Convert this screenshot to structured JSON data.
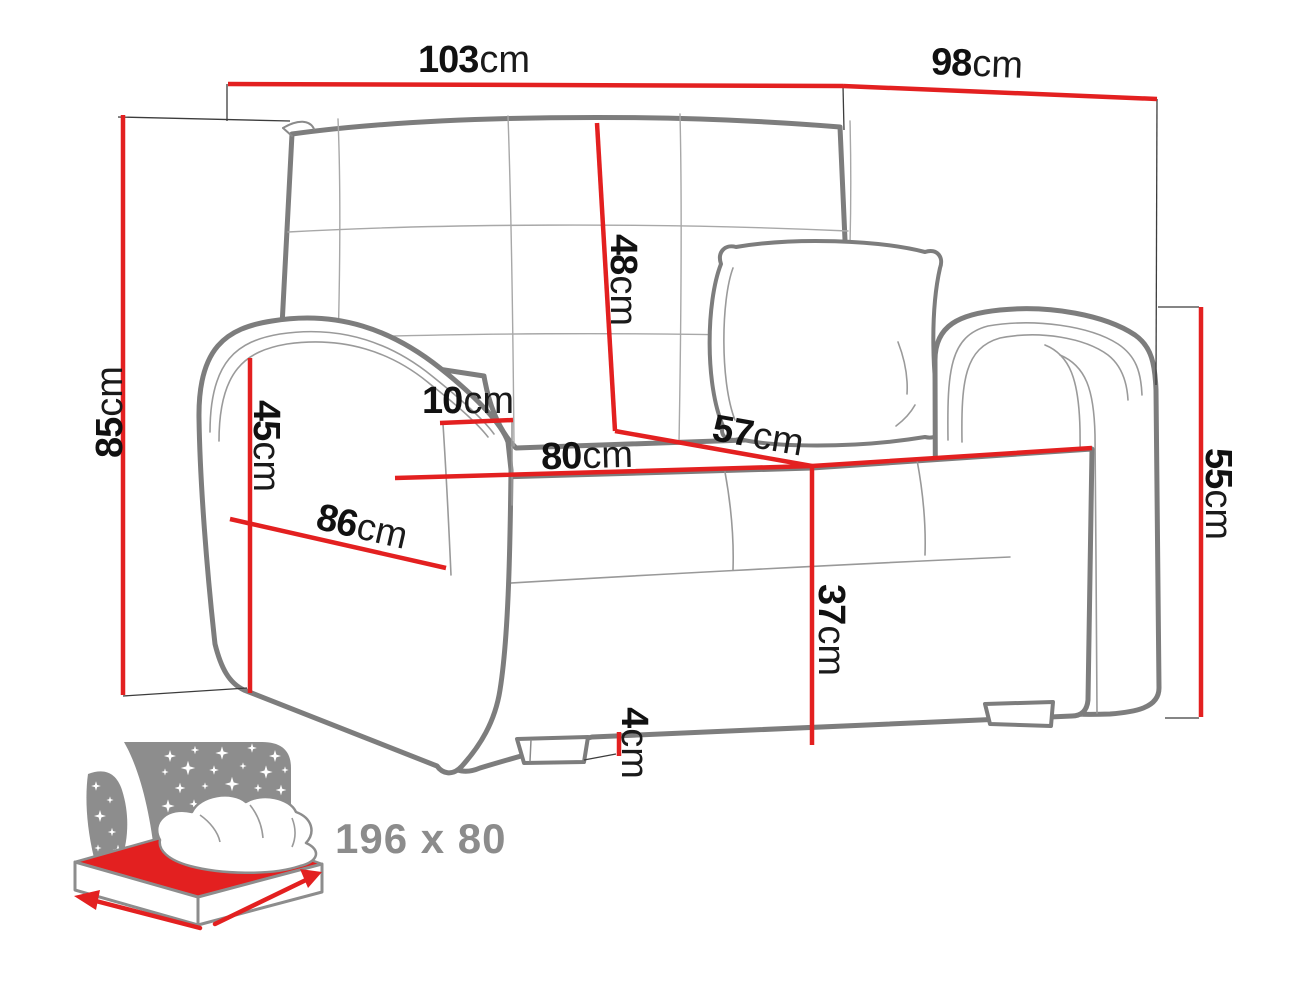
{
  "diagram": {
    "subject": "sofa-bed with dimension lines",
    "sleeping_area_label": "196 x 80"
  },
  "dimensions": {
    "overall_width": {
      "value": "103",
      "unit": "cm"
    },
    "overall_depth": {
      "value": "98",
      "unit": "cm"
    },
    "overall_height": {
      "value": "85",
      "unit": "cm"
    },
    "backrest_height": {
      "value": "48",
      "unit": "cm"
    },
    "armrest_top_width": {
      "value": "10",
      "unit": "cm"
    },
    "armrest_front_height": {
      "value": "45",
      "unit": "cm"
    },
    "side_depth": {
      "value": "86",
      "unit": "cm"
    },
    "seat_width": {
      "value": "80",
      "unit": "cm"
    },
    "seat_depth": {
      "value": "57",
      "unit": "cm"
    },
    "armrest_side_height": {
      "value": "55",
      "unit": "cm"
    },
    "seat_height": {
      "value": "37",
      "unit": "cm"
    },
    "leg_height": {
      "value": "4",
      "unit": "cm"
    }
  },
  "sleeping_area": {
    "label": "196 x 80"
  },
  "icons": {
    "bed_icon": "sleeper-bed-night-icon"
  },
  "colors": {
    "dimension_red": "#e32020",
    "outline_gray": "#7d7d7d",
    "detail_gray": "#9a9a9a",
    "witness_black": "#3c3c3c",
    "icon_gray": "#8d8d8d",
    "icon_text_gray": "#8c8c8c",
    "label_black": "#111111",
    "background": "#ffffff"
  }
}
